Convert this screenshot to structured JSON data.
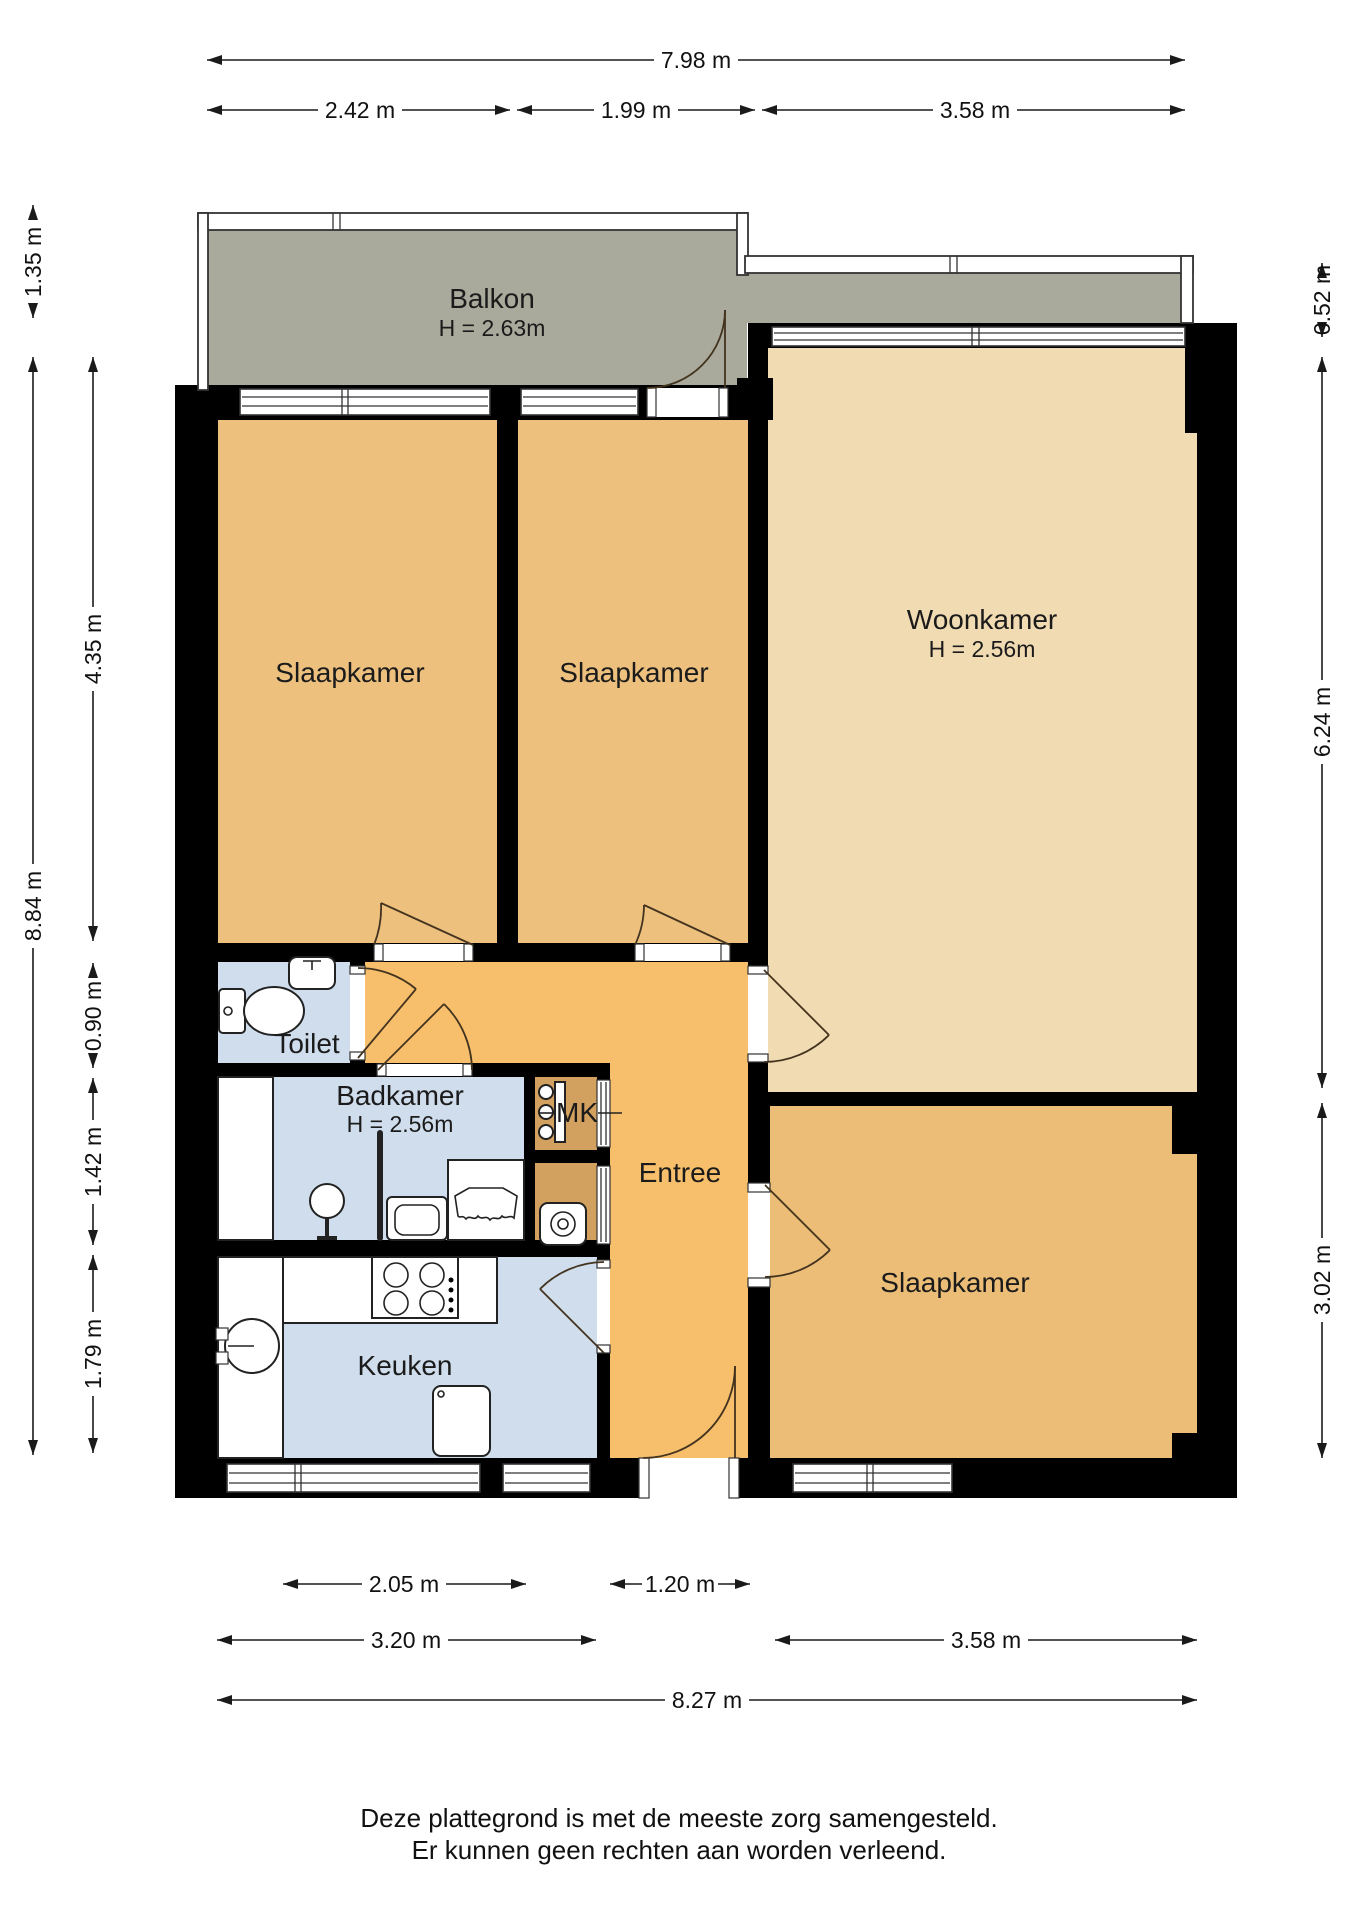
{
  "floorplan": {
    "rooms": {
      "balkon": {
        "label": "Balkon",
        "height": "H = 2.63m"
      },
      "slaapkamer_1": {
        "label": "Slaapkamer"
      },
      "slaapkamer_2": {
        "label": "Slaapkamer"
      },
      "woonkamer": {
        "label": "Woonkamer",
        "height": "H = 2.56m"
      },
      "toilet": {
        "label": "Toilet"
      },
      "badkamer": {
        "label": "Badkamer",
        "height": "H = 2.56m"
      },
      "mk": {
        "label": "MK"
      },
      "entree": {
        "label": "Entree"
      },
      "keuken": {
        "label": "Keuken"
      },
      "slaapkamer_3": {
        "label": "Slaapkamer"
      }
    },
    "dimensions": {
      "top_total": "7.98 m",
      "top_left": "2.42 m",
      "top_mid": "1.99 m",
      "top_right": "3.58 m",
      "left_balkon": "1.35 m",
      "left_slaapkamer": "4.35 m",
      "left_total": "8.84 m",
      "left_toilet": "0.90 m",
      "left_badkamer": "1.42 m",
      "left_keuken": "1.79 m",
      "right_balkon": "0.52 m",
      "right_woonkamer": "6.24 m",
      "right_slaapkamer": "3.02 m",
      "bottom_keuken_raam": "2.05 m",
      "bottom_voordeur": "1.20 m",
      "bottom_keuken": "3.20 m",
      "bottom_slaapkamer": "3.58 m",
      "bottom_total": "8.27 m"
    },
    "colors": {
      "wall": "#000000",
      "balcony": "#a9aa9b",
      "bedroom": "#edc07e",
      "living": "#f1dbb2",
      "hall": "#f7bf6b",
      "closet": "#d2a05f",
      "wet_room": "#cfddec",
      "dimension_lines": "#1a1a1a"
    },
    "footer": {
      "line1": "Deze plattegrond is met de meeste zorg samengesteld.",
      "line2": "Er kunnen geen rechten aan worden verleend."
    }
  }
}
